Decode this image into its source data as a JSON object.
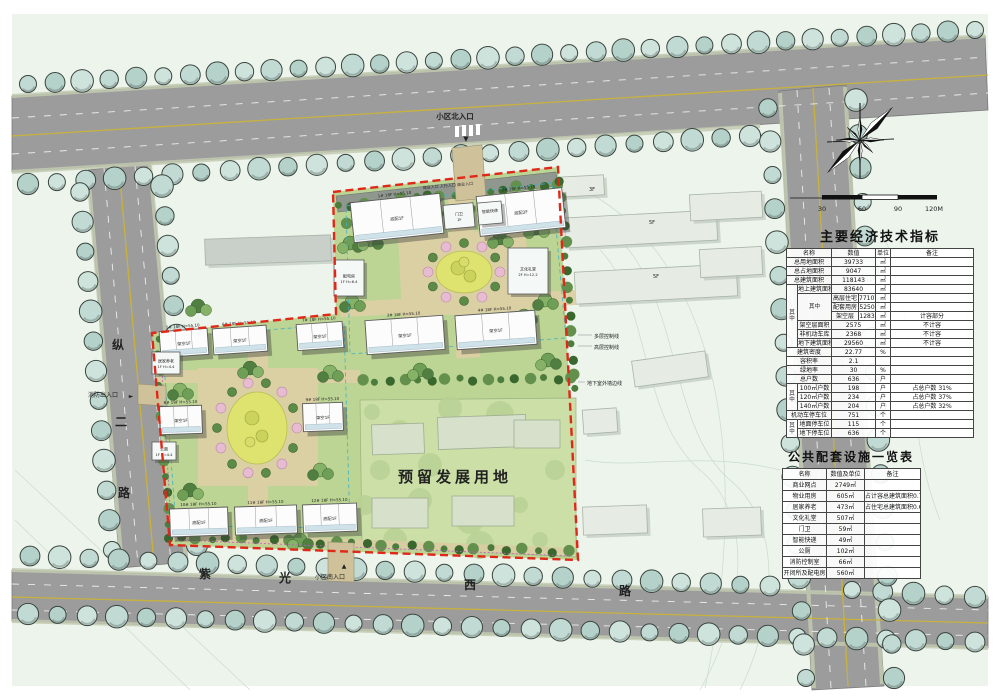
{
  "map": {
    "road_left": [
      "纵",
      "二",
      "路"
    ],
    "road_bottom": [
      "紫",
      "光",
      "西",
      "路"
    ],
    "entrances": {
      "north": "小区北入口",
      "south": "小区南入口",
      "fire": "消防出入口",
      "top_small": "商业入口   人行入口   商业入口"
    },
    "reserved_label": "预留发展用地",
    "annotations": [
      "多层控制线",
      "高层控制线",
      "地下室外墙边线"
    ],
    "existing_labels": [
      "3F",
      "5F",
      "5F"
    ],
    "buildings": {
      "slab_label": "18F H=55.10",
      "slabs": [
        {
          "id": "1#",
          "tag": "底配1F"
        },
        {
          "id": "2#",
          "tag": "底配2F"
        },
        {
          "id": "3#",
          "tag": "架空1F"
        },
        {
          "id": "4#",
          "tag": "架空1F"
        },
        {
          "id": "5#",
          "tag": "架空1F"
        },
        {
          "id": "6#",
          "tag": "架空1F"
        },
        {
          "id": "7#",
          "tag": "架空1F"
        },
        {
          "id": "8#",
          "tag": "架空1F"
        },
        {
          "id": "9#",
          "tag": "架空1F"
        },
        {
          "id": "10#",
          "tag": "底配1F"
        },
        {
          "id": "11#",
          "tag": "底配1F"
        },
        {
          "id": "12#",
          "tag": "底配1F"
        }
      ],
      "facilities": [
        {
          "name": "门卫",
          "tag": "1F"
        },
        {
          "name": "智能快递",
          "tag": ""
        },
        {
          "name": "文化礼堂",
          "tag": "2F H=12.2"
        },
        {
          "name": "配电房",
          "tag": "1F H=6.4"
        },
        {
          "name": "居家养老",
          "tag": "1F H=4.4"
        },
        {
          "name": "公厕",
          "tag": "1F H=4.4"
        }
      ]
    }
  },
  "scalebar": {
    "ticks": [
      "30",
      "60",
      "90",
      "120M"
    ]
  },
  "table1": {
    "title": "主要经济技术指标",
    "rows": [
      [
        {
          "t": "名称",
          "c": 2
        },
        {
          "t": "数值",
          "c": 2
        },
        {
          "t": "单位"
        },
        {
          "t": "备注"
        }
      ],
      [
        {
          "t": "总用地面积",
          "c": 2
        },
        {
          "t": "39733",
          "c": 2
        },
        {
          "t": "㎡"
        },
        {
          "t": ""
        }
      ],
      [
        {
          "t": "总占地面积",
          "c": 2
        },
        {
          "t": "9047",
          "c": 2
        },
        {
          "t": "㎡"
        },
        {
          "t": ""
        }
      ],
      [
        {
          "t": "总建筑面积",
          "c": 2
        },
        {
          "t": "118143",
          "c": 2
        },
        {
          "t": "㎡"
        },
        {
          "t": ""
        }
      ],
      [
        {
          "t": "其中",
          "r": 7,
          "v": 1
        },
        {
          "t": "地上建筑面积"
        },
        {
          "t": "83640",
          "c": 2
        },
        {
          "t": "㎡"
        },
        {
          "t": ""
        }
      ],
      [
        {
          "t": "其中",
          "r": 3,
          "v": 1
        },
        {
          "t": "高层住宅"
        },
        {
          "t": "77107"
        },
        {
          "t": "㎡"
        },
        {
          "t": ""
        }
      ],
      [
        {
          "t": "配套用房"
        },
        {
          "t": "5250"
        },
        {
          "t": "㎡"
        },
        {
          "t": ""
        }
      ],
      [
        {
          "t": "架空层"
        },
        {
          "t": "1283"
        },
        {
          "t": "㎡"
        },
        {
          "t": "计容部分"
        }
      ],
      [
        {
          "t": "架空层面积"
        },
        {
          "t": "2575",
          "c": 2
        },
        {
          "t": "㎡"
        },
        {
          "t": "不计容"
        }
      ],
      [
        {
          "t": "非机动车库"
        },
        {
          "t": "2368",
          "c": 2
        },
        {
          "t": "㎡"
        },
        {
          "t": "不计容"
        }
      ],
      [
        {
          "t": "地下建筑面积"
        },
        {
          "t": "29560",
          "c": 2
        },
        {
          "t": "㎡"
        },
        {
          "t": "不计容"
        }
      ],
      [
        {
          "t": "建筑密度",
          "c": 2
        },
        {
          "t": "22.77",
          "c": 2
        },
        {
          "t": "%"
        },
        {
          "t": ""
        }
      ],
      [
        {
          "t": "容积率",
          "c": 2
        },
        {
          "t": "2.1",
          "c": 2
        },
        {
          "t": ""
        },
        {
          "t": ""
        }
      ],
      [
        {
          "t": "绿地率",
          "c": 2
        },
        {
          "t": "30",
          "c": 2
        },
        {
          "t": "%"
        },
        {
          "t": ""
        }
      ],
      [
        {
          "t": "总户数",
          "c": 2
        },
        {
          "t": "636",
          "c": 2
        },
        {
          "t": "户"
        },
        {
          "t": ""
        }
      ],
      [
        {
          "t": "其中",
          "r": 3,
          "v": 1
        },
        {
          "t": "100㎡户数"
        },
        {
          "t": "198",
          "c": 2
        },
        {
          "t": "户"
        },
        {
          "t": "占总户数 31%"
        }
      ],
      [
        {
          "t": "120㎡户数"
        },
        {
          "t": "234",
          "c": 2
        },
        {
          "t": "户"
        },
        {
          "t": "占总户数 37%"
        }
      ],
      [
        {
          "t": "140㎡户数"
        },
        {
          "t": "204",
          "c": 2
        },
        {
          "t": "户"
        },
        {
          "t": "占总户数 32%"
        }
      ],
      [
        {
          "t": "机动车停车位",
          "c": 2
        },
        {
          "t": "751",
          "c": 2
        },
        {
          "t": "个"
        },
        {
          "t": ""
        }
      ],
      [
        {
          "t": "其中",
          "r": 2,
          "v": 1
        },
        {
          "t": "地面停车位"
        },
        {
          "t": "115",
          "c": 2
        },
        {
          "t": "个"
        },
        {
          "t": ""
        }
      ],
      [
        {
          "t": "地下停车位"
        },
        {
          "t": "636",
          "c": 2
        },
        {
          "t": "个"
        },
        {
          "t": ""
        }
      ]
    ]
  },
  "table2": {
    "title": "公共配套设施一览表",
    "headers": [
      "名称",
      "数值及单位",
      "备注"
    ],
    "rows": [
      [
        "商业网点",
        "2749㎡",
        ""
      ],
      [
        "物业用房",
        "605㎡",
        "占计容总建筑面积0.72%"
      ],
      [
        "居家养老",
        "473㎡",
        "占住宅总建筑面积0.61%"
      ],
      [
        "文化礼堂",
        "507㎡",
        ""
      ],
      [
        "门卫",
        "59㎡",
        ""
      ],
      [
        "智能快递",
        "49㎡",
        ""
      ],
      [
        "公厕",
        "102㎡",
        ""
      ],
      [
        "消防控制室",
        "66㎡",
        ""
      ],
      [
        "开闭所及配电房",
        "560㎡",
        ""
      ]
    ]
  }
}
